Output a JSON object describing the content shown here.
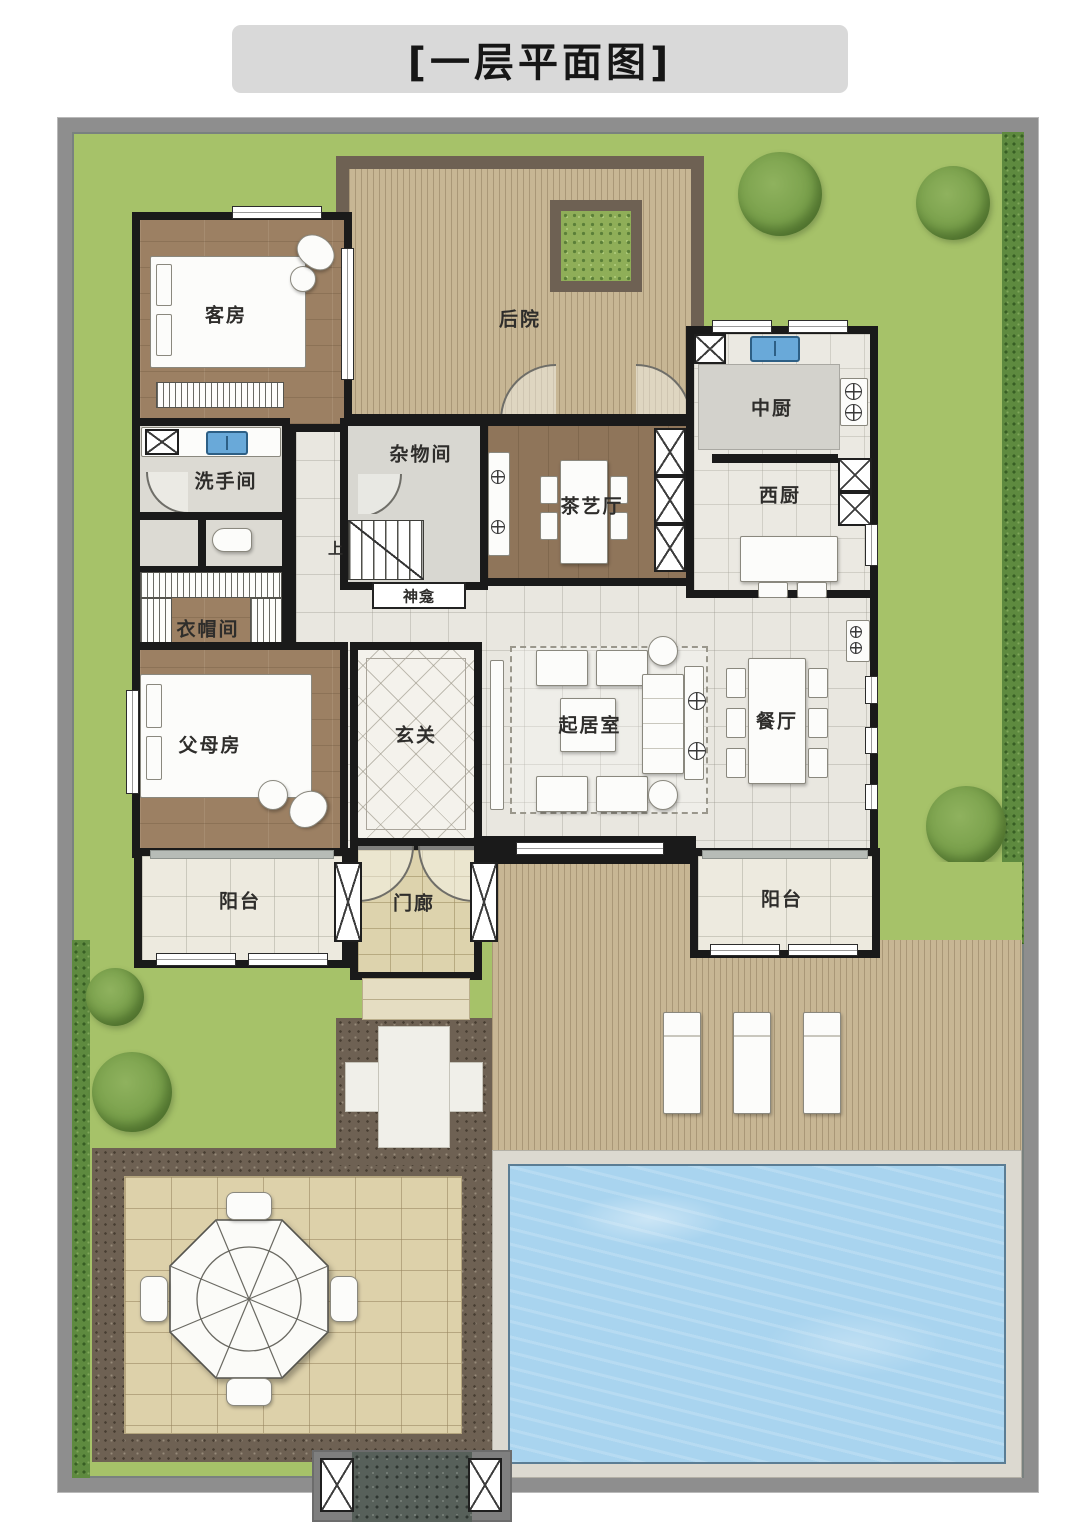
{
  "title": "[一层平面图]",
  "rooms": {
    "guest_room": "客房",
    "backyard": "后院",
    "chinese_kitchen": "中厨",
    "storage_room": "杂物间",
    "washroom": "洗手间",
    "tea_hall": "茶艺厅",
    "western_kitchen": "西厨",
    "shrine": "神龛",
    "cloakroom": "衣帽间",
    "parents_room": "父母房",
    "foyer": "玄关",
    "living_room": "起居室",
    "dining_room": "餐厅",
    "balcony_left": "阳台",
    "porch": "门廊",
    "balcony_right": "阳台"
  },
  "annotations": {
    "stairs_up": "上"
  },
  "colors": {
    "title_bg": "#d9d9d9",
    "grass": "#a6c269",
    "site_wall": "#8e8e8e",
    "deck_wood": "#c7b694",
    "gravel": "#6e6153",
    "pool_water": "#a9d4ef",
    "pool_deck": "#dcd9d0",
    "patio_tile": "#ddd1aa",
    "interior_wall": "#1a1a1a",
    "hall_tile": "#e9e7e0",
    "room_wood": "#9c8063",
    "sink_blue": "#69a9d9"
  }
}
